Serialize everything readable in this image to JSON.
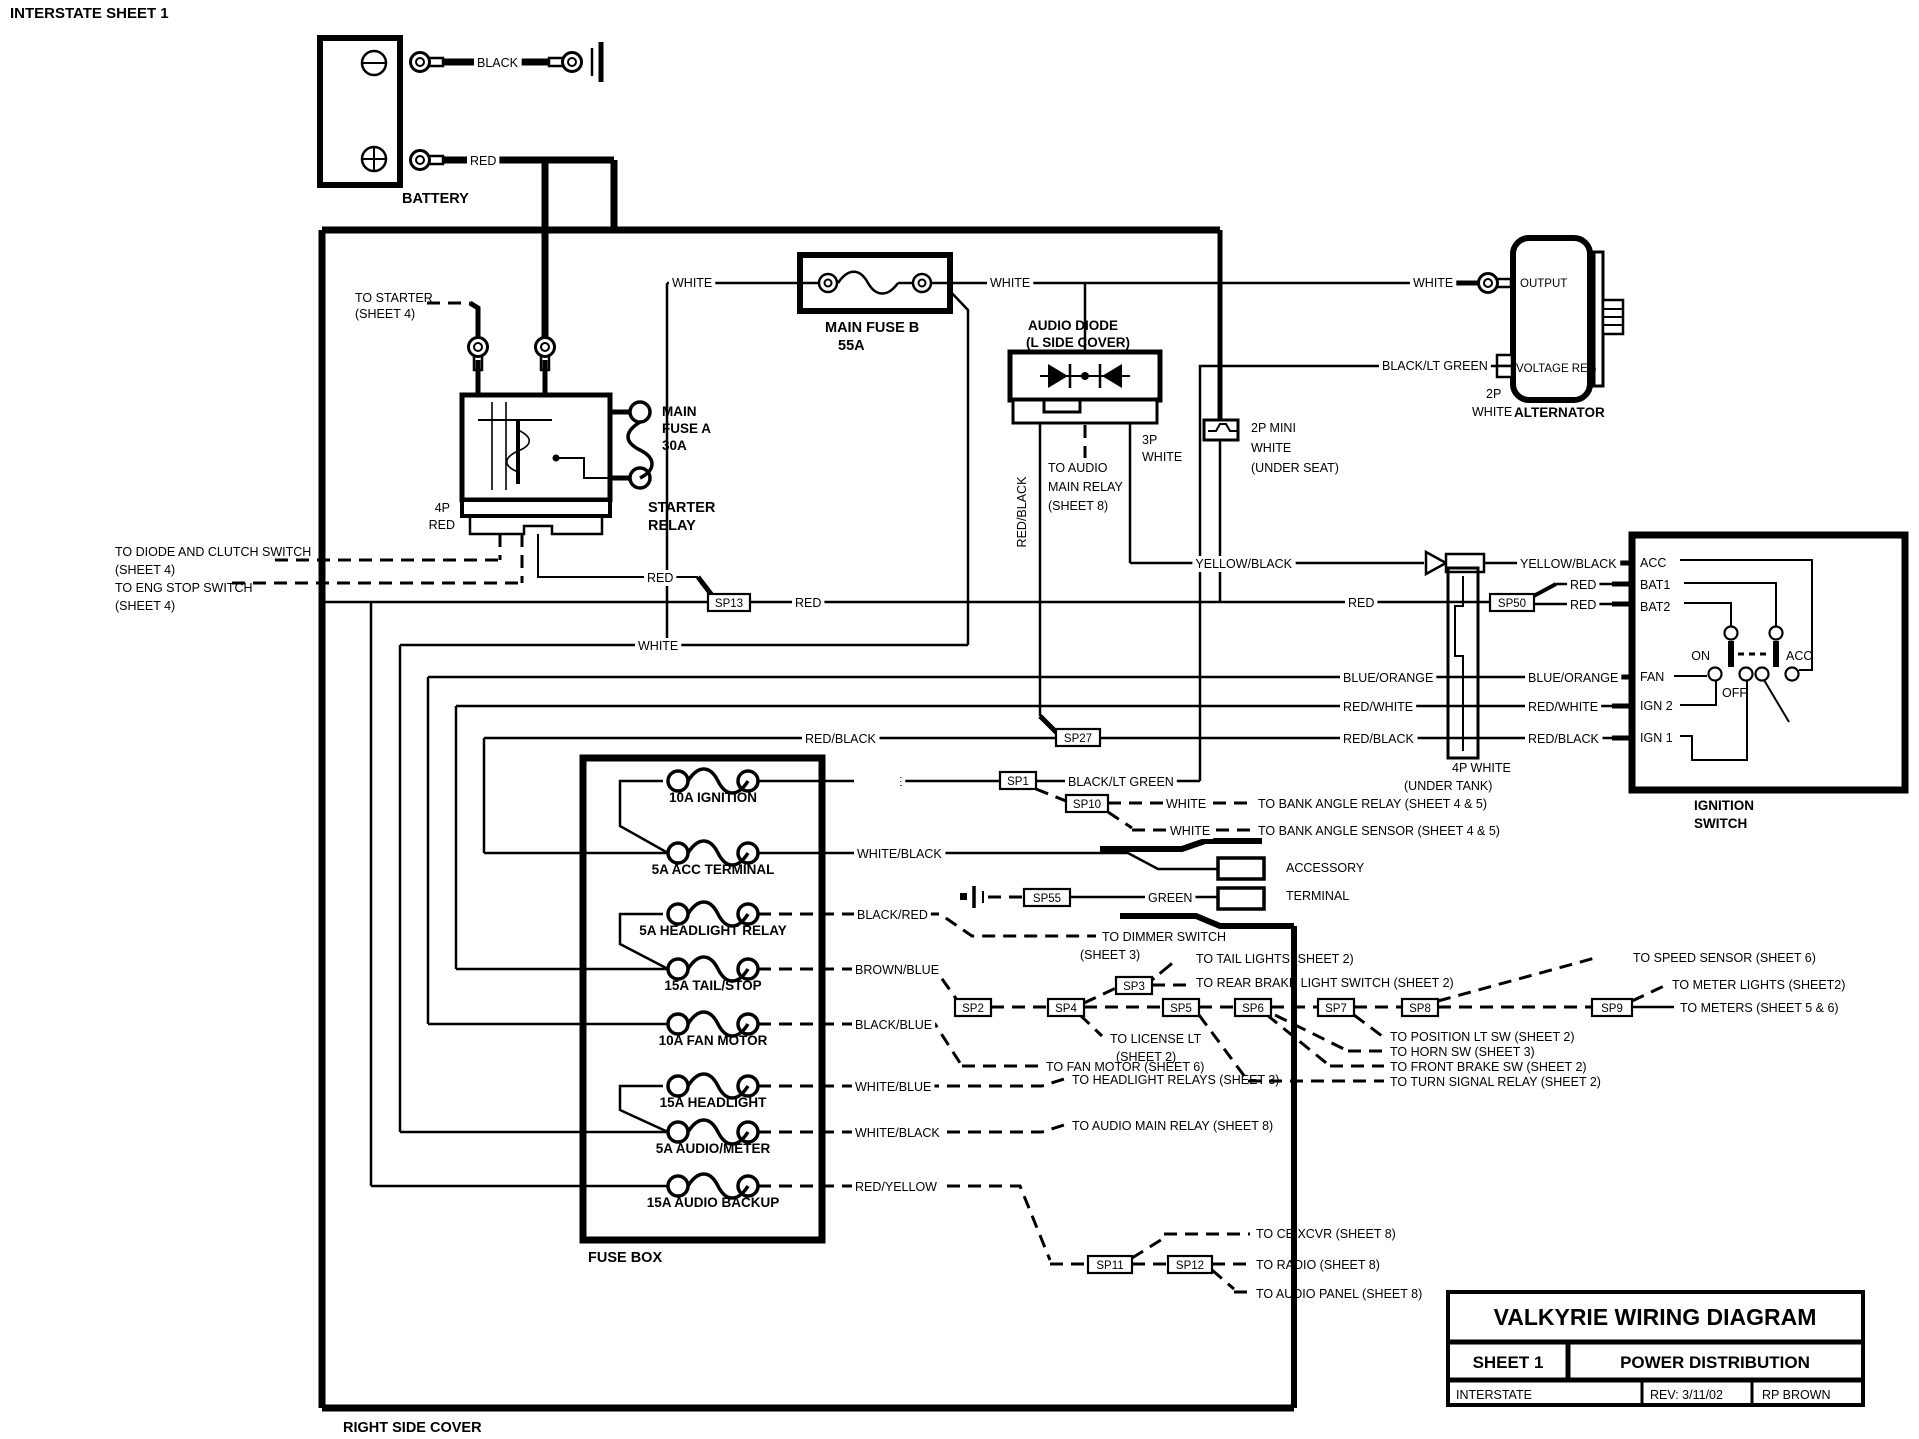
{
  "header": "INTERSTATE SHEET 1",
  "battery": {
    "label": "BATTERY",
    "neg_wire": "BLACK",
    "pos_wire": "RED"
  },
  "starter_relay": {
    "label_1": "STARTER",
    "label_2": "RELAY",
    "connector_1": "4P",
    "connector_2": "RED",
    "to_starter": "TO STARTER",
    "sheet4": "(SHEET 4)",
    "fuse_1": "MAIN",
    "fuse_2": "FUSE A",
    "fuse_3": "30A",
    "to_diode": "TO DIODE AND CLUTCH SWITCH",
    "to_eng": "TO ENG STOP SWITCH"
  },
  "main_fuse_b": {
    "label": "MAIN FUSE B",
    "amps": "55A"
  },
  "audio_diode": {
    "label_1": "AUDIO DIODE",
    "label_2": "(L SIDE COVER)",
    "conn_1": "3P",
    "dest_1": "TO AUDIO",
    "dest_2": "MAIN RELAY",
    "dest_3": "(SHEET 8)"
  },
  "mini_conn": {
    "label_1": "2P MINI",
    "label_2": "WHITE",
    "label_3": "(UNDER SEAT)"
  },
  "alternator": {
    "label": "ALTERNATOR",
    "output": "OUTPUT",
    "voltage_reg": "VOLTAGE REG",
    "conn_1": "2P",
    "conn_2": "WHITE"
  },
  "wires": {
    "white": "WHITE",
    "red": "RED",
    "black": "BLACK",
    "yellow_black": "YELLOW/BLACK",
    "black_lt_green": "BLACK/LT GREEN",
    "blue_orange": "BLUE/ORANGE",
    "red_white": "RED/WHITE",
    "red_black": "RED/BLACK",
    "white_black": "WHITE/BLACK",
    "green": "GREEN"
  },
  "ignition_switch": {
    "label_1": "IGNITION",
    "label_2": "SWITCH",
    "terminals": [
      "ACC",
      "BAT1",
      "BAT2",
      "FAN",
      "IGN 2",
      "IGN 1"
    ],
    "positions": {
      "on": "ON",
      "off": "OFF",
      "acc": "ACC"
    },
    "conn_label_1": "4P WHITE",
    "conn_label_2": "(UNDER TANK)"
  },
  "splices": {
    "sp1": "SP1",
    "sp2": "SP2",
    "sp3": "SP3",
    "sp4": "SP4",
    "sp5": "SP5",
    "sp6": "SP6",
    "sp7": "SP7",
    "sp8": "SP8",
    "sp9": "SP9",
    "sp10": "SP10",
    "sp11": "SP11",
    "sp12": "SP12",
    "sp13": "SP13",
    "sp27": "SP27",
    "sp50": "SP50",
    "sp55": "SP55"
  },
  "accessory": {
    "label_1": "ACCESSORY",
    "label_2": "TERMINAL"
  },
  "fuse_box": {
    "label": "FUSE BOX",
    "fuses": [
      {
        "label": "10A IGNITION",
        "wire": "WHITE"
      },
      {
        "label": "5A ACC TERMINAL",
        "wire": "WHITE/BLACK"
      },
      {
        "label": "5A HEADLIGHT RELAY",
        "wire": "BLACK/RED"
      },
      {
        "label": "15A TAIL/STOP",
        "wire": "BROWN/BLUE"
      },
      {
        "label": "10A FAN MOTOR",
        "wire": "BLACK/BLUE"
      },
      {
        "label": "15A HEADLIGHT",
        "wire": "WHITE/BLUE"
      },
      {
        "label": "5A AUDIO/METER",
        "wire": "WHITE/BLACK"
      },
      {
        "label": "15A AUDIO BACKUP",
        "wire": "RED/YELLOW"
      }
    ]
  },
  "destinations": {
    "bank_angle_relay": "TO BANK ANGLE RELAY  (SHEET 4 & 5)",
    "bank_angle_sensor": "TO BANK ANGLE SENSOR (SHEET 4 & 5)",
    "dimmer_1": "TO DIMMER SWITCH",
    "dimmer_2": "(SHEET 3)",
    "tail_lights": "TO TAIL LIGHTS  (SHEET 2)",
    "rear_brake": "TO REAR BRAKE LIGHT SWITCH (SHEET 2)",
    "license_1": "TO  LICENSE LT",
    "license_2": "(SHEET 2)",
    "fan_motor": "TO FAN MOTOR  (SHEET 6)",
    "position": "TO POSITION LT SW (SHEET 2)",
    "horn": "TO  HORN SW (SHEET 3)",
    "front_brake": "TO FRONT BRAKE SW (SHEET 2)",
    "turn_signal": "TO TURN SIGNAL RELAY (SHEET 2)",
    "speed_sensor": "TO SPEED SENSOR (SHEET 6)",
    "meter_lights": "TO METER LIGHTS (SHEET2)",
    "meters": "TO METERS (SHEET 5 & 6)",
    "headlight_relays": "TO HEADLIGHT RELAYS (SHEET 3)",
    "audio_main_relay": "TO AUDIO MAIN RELAY (SHEET 8)",
    "cb_xcvr": "TO CB XCVR (SHEET 8)",
    "radio": "TO RADIO (SHEET 8)",
    "audio_panel": "TO AUDIO PANEL (SHEET 8)"
  },
  "footer": {
    "right_side_cover": "RIGHT SIDE COVER"
  },
  "title_block": {
    "title": "VALKYRIE WIRING DIAGRAM",
    "sheet": "SHEET 1",
    "subtitle": "POWER DISTRIBUTION",
    "model": "INTERSTATE",
    "rev": "REV: 3/11/02",
    "author": "RP BROWN"
  }
}
